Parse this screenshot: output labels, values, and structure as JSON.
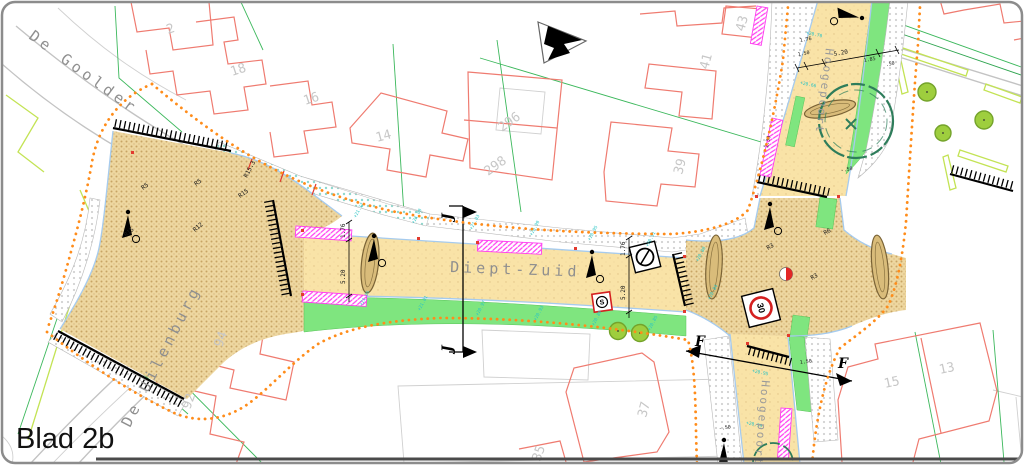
{
  "sheet": {
    "label": "Blad 2b"
  },
  "streets": {
    "de_goolder": "De Goolder",
    "de_uilenburg": "De Uilenburg",
    "diept_zuid": "Diept-Zuid",
    "hoog_upper": "Hoogepoort",
    "hoog_lower": "Hoogepoort"
  },
  "buildings": [
    "2",
    "18",
    "16",
    "14",
    "296",
    "298",
    "39",
    "41",
    "43",
    "94",
    "92",
    "37",
    "35",
    "15",
    "13"
  ],
  "radii": [
    "R5",
    "R5",
    "R15",
    "R15.3",
    "R12",
    "R15",
    "R3",
    "R6",
    "R3"
  ],
  "dims": [
    "1.76",
    "5.20",
    "1.76",
    "5.20",
    "1.76",
    "1.50",
    "5.20",
    "1.85",
    ".50",
    "2.30",
    "-.50",
    "1.50",
    "-.50"
  ],
  "sections": {
    "j": "J",
    "f": "F"
  },
  "signs": {
    "zone_30": "30",
    "s_box": "S"
  },
  "elevations": [
    "+21.12",
    "+21.08",
    "+21.03",
    "+20.99",
    "+20.95",
    "+20.91",
    "+21.05",
    "+21.01",
    "+20.97",
    "+20.93",
    "+20.89",
    "+20.85",
    "+20.88",
    "+20.84",
    "+20.70",
    "+20.66",
    "+20.95",
    "+20.99"
  ],
  "colors": {
    "boundary_orange": "#FF8C1A",
    "verge_green": "#7FE57F",
    "pavement_tan": "#F8E1A3",
    "plaza_tan": "#EDD49E",
    "curb_blue": "#A6CBEE",
    "parking_magenta": "#FF3DF0",
    "building_red": "#EF7B70",
    "elevation_cyan": "#29C4C4"
  }
}
